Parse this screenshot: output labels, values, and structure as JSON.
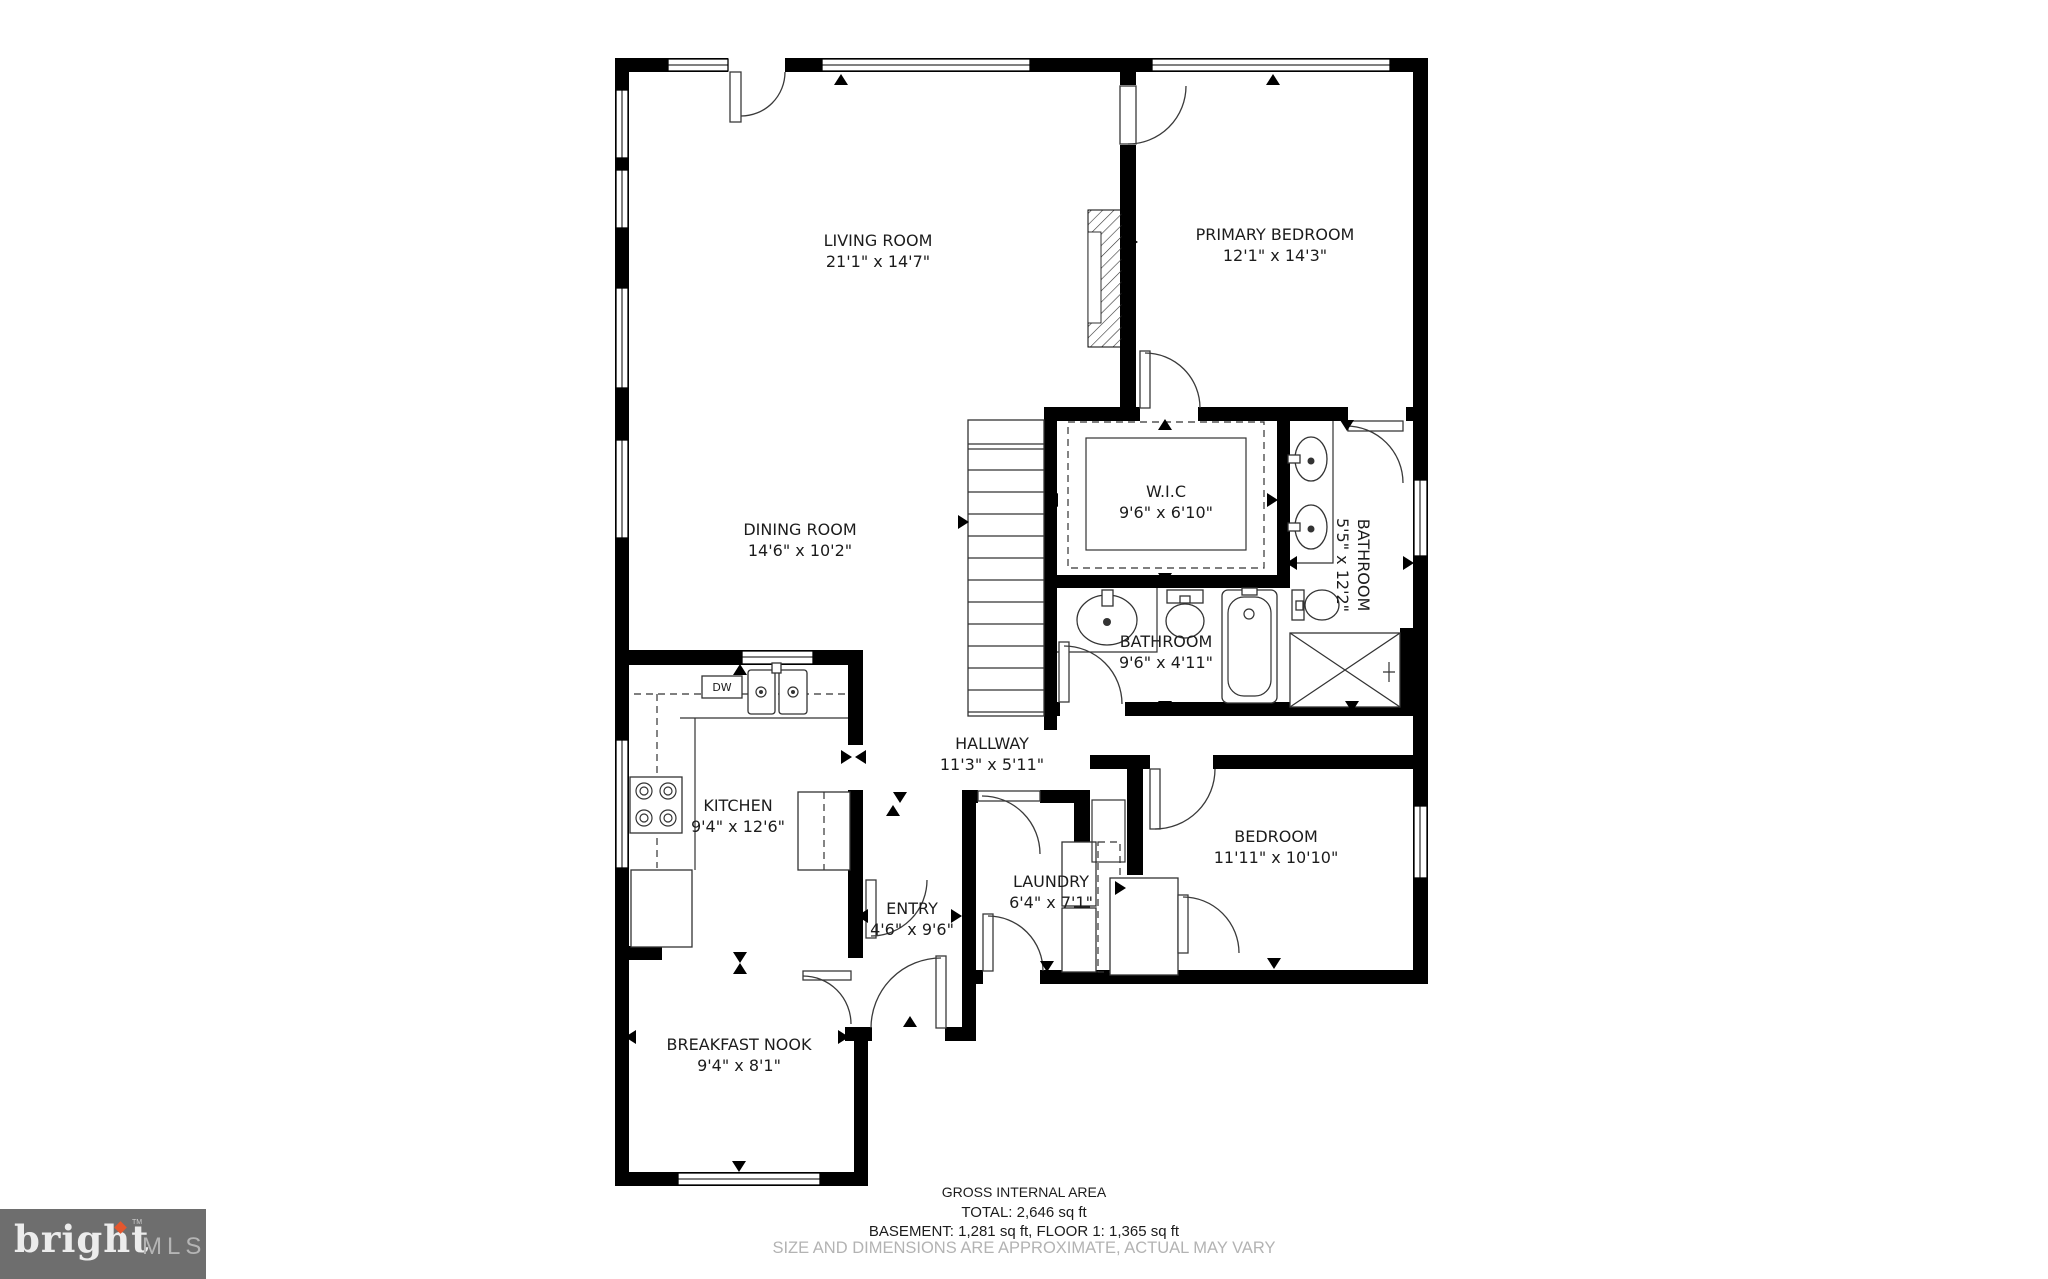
{
  "floor_plan": {
    "rooms": [
      {
        "name": "LIVING ROOM",
        "dims": "21'1\" x 14'7\""
      },
      {
        "name": "PRIMARY BEDROOM",
        "dims": "12'1\" x 14'3\""
      },
      {
        "name": "DINING ROOM",
        "dims": "14'6\" x 10'2\""
      },
      {
        "name": "W.I.C",
        "dims": "9'6\" x 6'10\""
      },
      {
        "name": "BATHROOM",
        "dims": "5'5\" x 12'2\""
      },
      {
        "name": "BATHROOM",
        "dims": "9'6\" x 4'11\""
      },
      {
        "name": "HALLWAY",
        "dims": "11'3\" x 5'11\""
      },
      {
        "name": "KITCHEN",
        "dims": "9'4\" x 12'6\""
      },
      {
        "name": "LAUNDRY",
        "dims": "6'4\" x 7'1\""
      },
      {
        "name": "ENTRY",
        "dims": "4'6\" x 9'6\""
      },
      {
        "name": "BEDROOM",
        "dims": "11'11\" x 10'10\""
      },
      {
        "name": "BREAKFAST NOOK",
        "dims": "9'4\" x 8'1\""
      }
    ],
    "fixtures": {
      "dishwasher_label": "DW"
    },
    "footer": {
      "title": "GROSS INTERNAL AREA",
      "total": "TOTAL: 2,646 sq ft",
      "breakdown": "BASEMENT: 1,281 sq ft, FLOOR 1: 1,365 sq ft",
      "disclaimer": "SIZE AND DIMENSIONS ARE APPROXIMATE, ACTUAL MAY VARY"
    },
    "logo": {
      "brand": "bright",
      "suffix": "MLS",
      "trademark": "TM"
    },
    "colors": {
      "walls": "#000000",
      "text": "#1c1c1c",
      "muted": "#b3b3b3",
      "logo_bg": "#6e6e6e",
      "logo_brand": "#ececec",
      "logo_suffix": "#b5b5b5",
      "accent": "#e4572e"
    }
  }
}
